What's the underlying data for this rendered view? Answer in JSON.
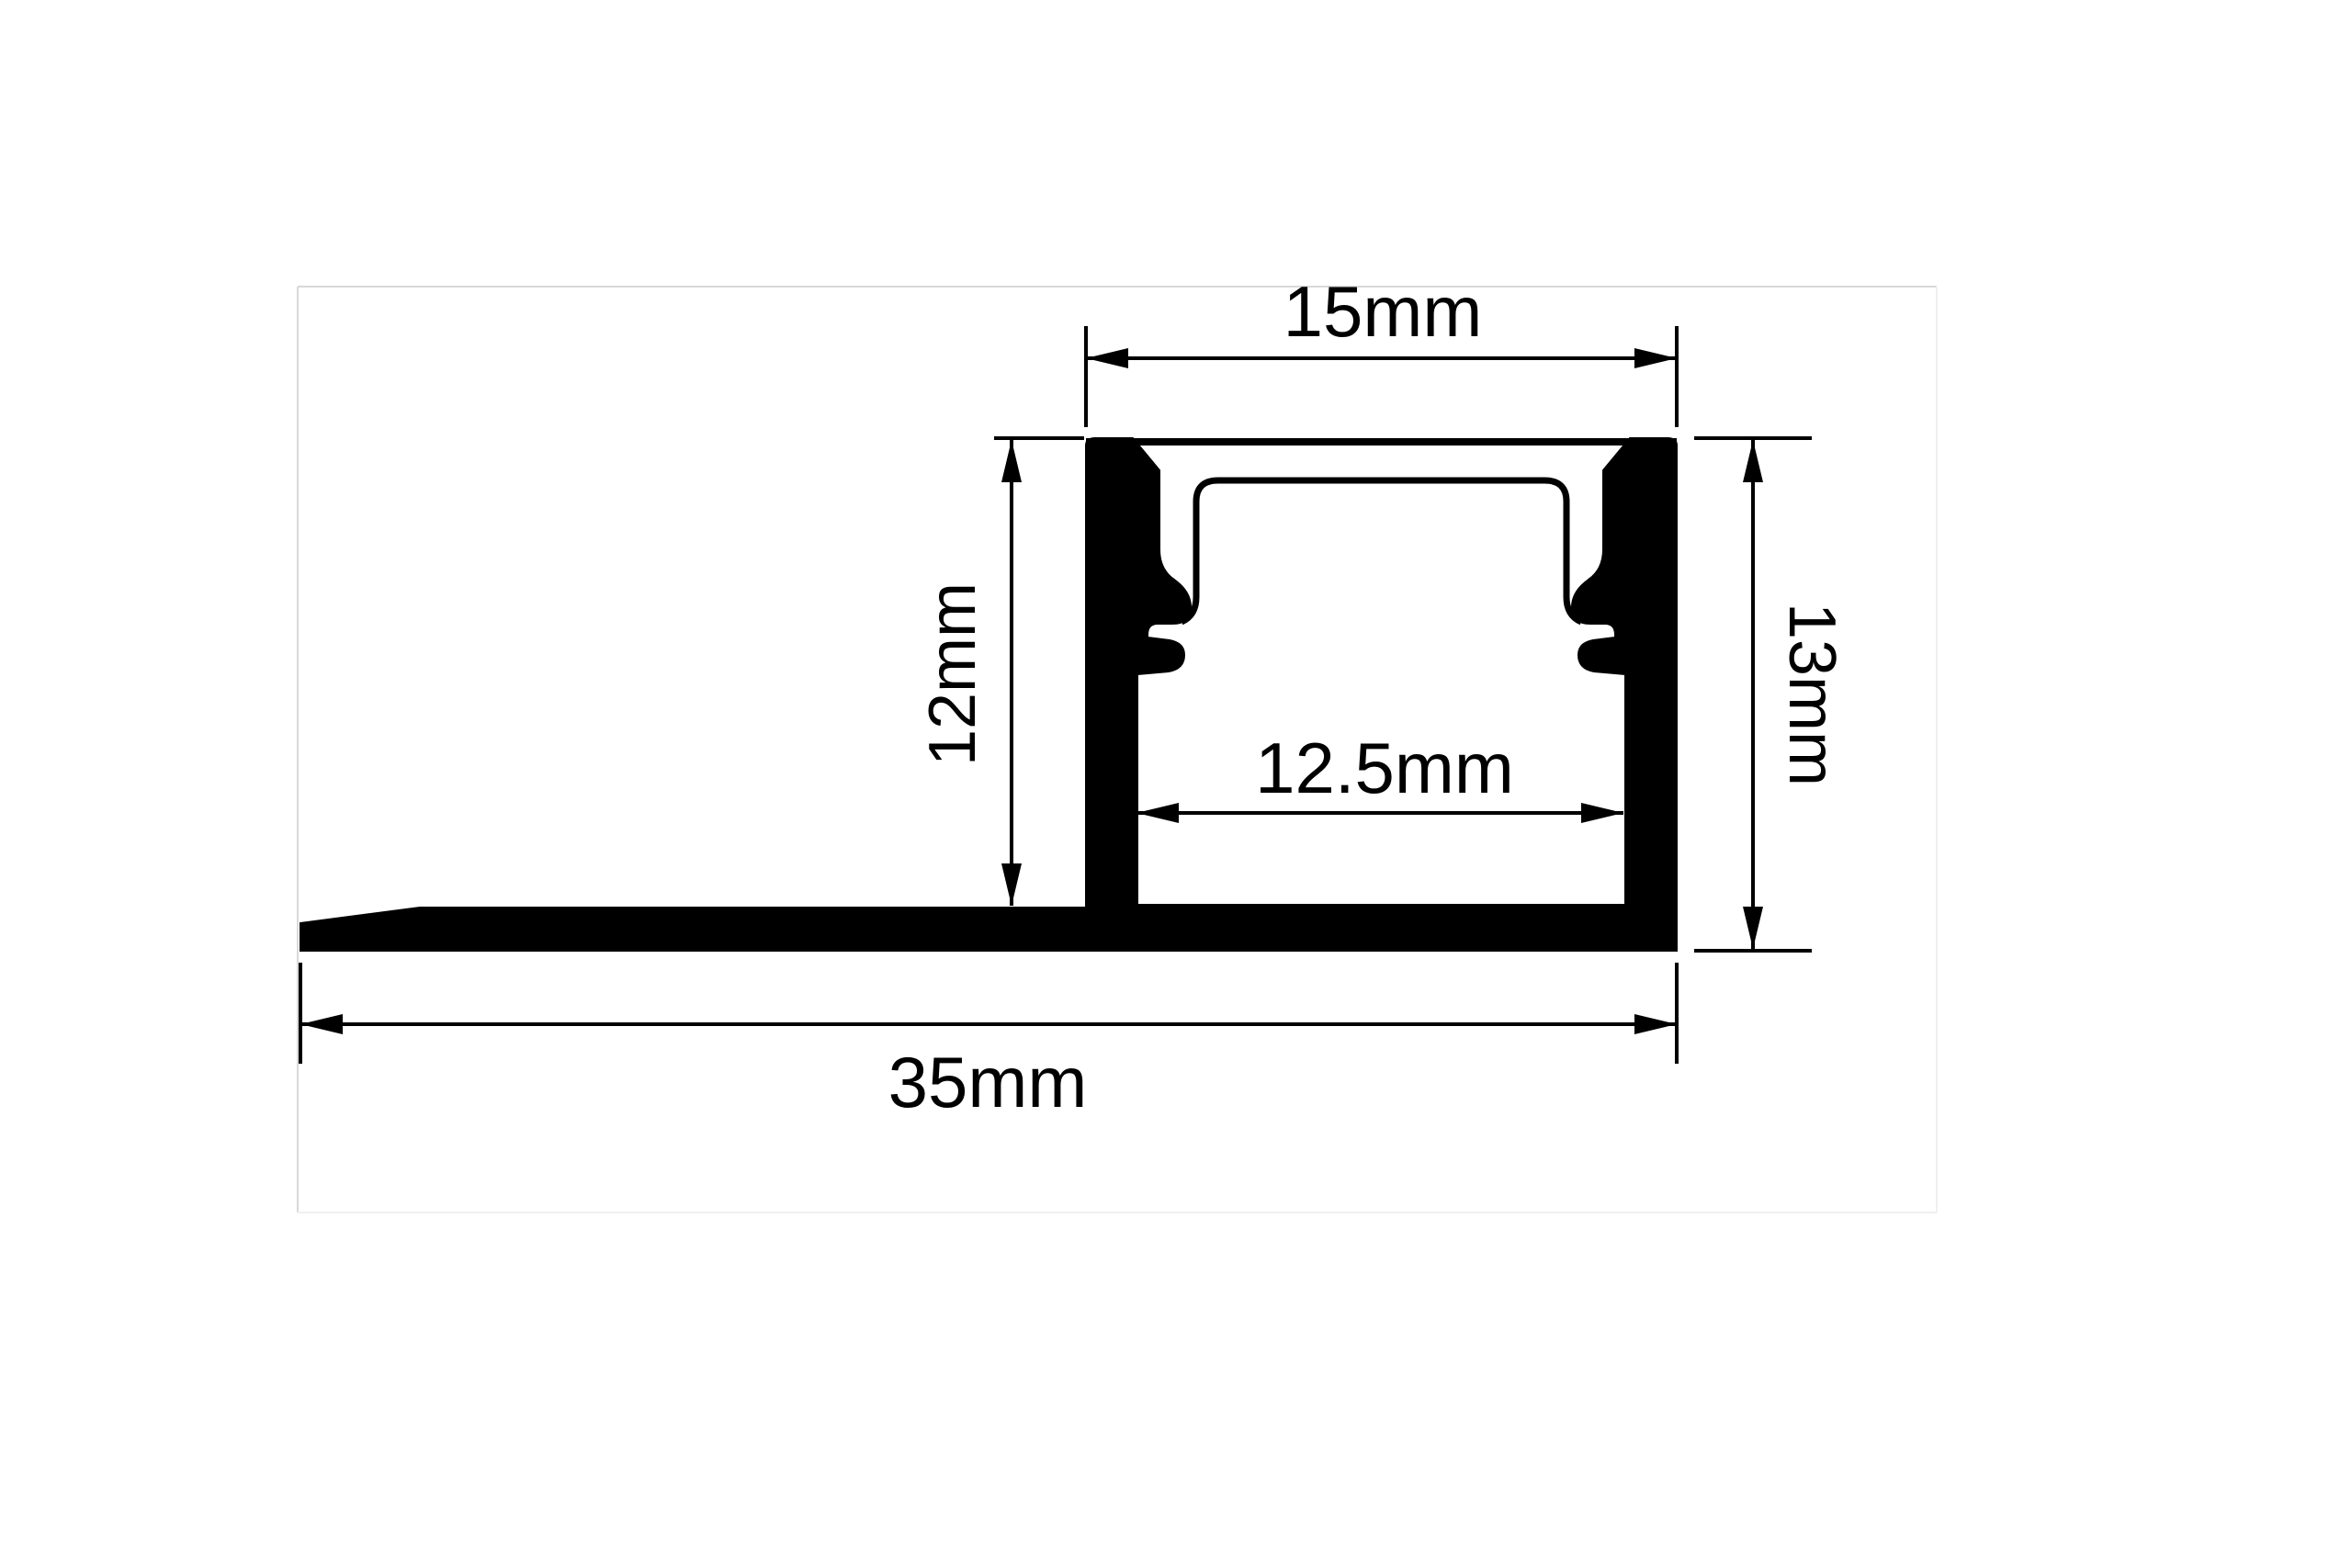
{
  "page": {
    "background": "#ffffff",
    "border_color": "#d9d9d9",
    "line_color": "#000000"
  },
  "drawing": {
    "labels": {
      "top_width": "15mm",
      "left_height": "12mm",
      "right_height": "13mm",
      "inner_width": "12.5mm",
      "total_width": "35mm"
    },
    "dimensions_mm": {
      "top_width": 15,
      "left_height": 12,
      "right_height": 13,
      "inner_width": 12.5,
      "total_width": 35
    }
  }
}
